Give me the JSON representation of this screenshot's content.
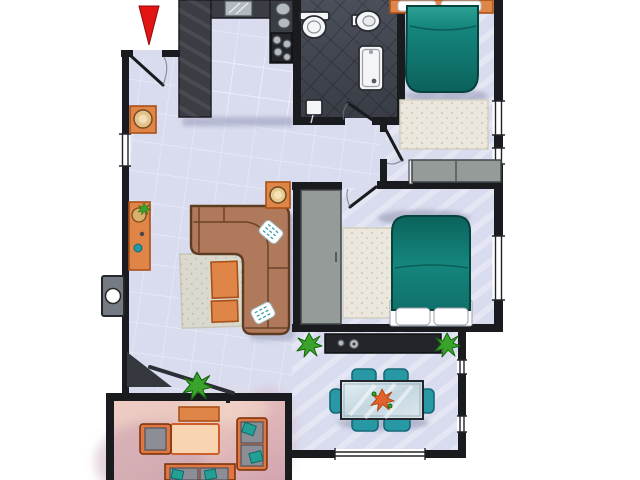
{
  "image": {
    "kind": "hand-drawn apartment floor plan illustration",
    "visible_text": "none",
    "orientation": "top-down",
    "cropped_edges": [
      "top",
      "bottom"
    ]
  },
  "palette": {
    "outside": "#ffffff",
    "wall": "#1a1b1f",
    "floor_main": "#d9dcef",
    "tile_line": "#f4f6ff",
    "floor_bath": "#4a4f59",
    "bath_grout": "#343842",
    "counter": "#3a3d44",
    "counter_dark": "#23252a",
    "balcony": "#e5bfbc",
    "balcony_shade": "#bb93a8",
    "rug": "#ebe7dc",
    "rug_living": "#dbd9ce",
    "sofa": "#b0795b",
    "sofa_line": "#5e3c22",
    "teal": "#15867d",
    "teal_dark": "#0a5a55",
    "orange": "#e08548",
    "orange_deep": "#a85118",
    "peach": "#f8d4b0",
    "chair": "#2798a4",
    "chair_dark": "#136a76",
    "plant": "#3aa32b",
    "plant_dark": "#17660d",
    "gray_furniture": "#959b99",
    "gray_cushion": "#8d8d96",
    "metal": "#b3bac1",
    "red": "#e21414",
    "white": "#ffffff",
    "glass": "#ccdbe4",
    "shadow": "#8d92ad"
  },
  "markers": {
    "entrance_arrow": {
      "shape": "triangle-pointing-down",
      "color": "#e21414"
    },
    "exterior_utility_box": {
      "shape": "gray-box-with-circle",
      "location": "outside-left-wall"
    }
  },
  "rooms": {
    "entry": {
      "name": "Entry",
      "features": [
        "entrance-door-open",
        "orange-stool"
      ]
    },
    "kitchen": {
      "name": "Kitchen",
      "features": [
        "u-shaped-dark-counter",
        "sink",
        "cooktop-burners",
        "pots"
      ]
    },
    "bathroom": {
      "name": "Bathroom",
      "features": [
        "dark-tiled-floor",
        "toilet",
        "bidet",
        "shower-tray",
        "floor-scale",
        "door"
      ]
    },
    "hallway": {
      "name": "Hallway",
      "features": []
    },
    "bedroom_main": {
      "name": "Bedroom 1",
      "features": [
        "teal-double-bed",
        "orange-headboard",
        "two-pillows",
        "beige-rug",
        "gray-wardrobe",
        "door",
        "windows-right-wall"
      ]
    },
    "bedroom_second": {
      "name": "Bedroom 2",
      "features": [
        "teal-double-bed",
        "two-pillows",
        "beige-rug",
        "gray-wardrobe",
        "door",
        "window-right-wall"
      ]
    },
    "living_room": {
      "name": "Living Room",
      "features": [
        "l-shaped-brown-sofa",
        "two-teal-pillows",
        "gray-rug",
        "two-orange-ottomans",
        "orange-console",
        "side-table-with-lamp",
        "corner-shelf",
        "plant",
        "window-left-wall"
      ]
    },
    "dining_room": {
      "name": "Dining Room",
      "features": [
        "dark-sideboard",
        "two-plants",
        "glass-table",
        "six-teal-chairs",
        "orange-centerpiece",
        "windows"
      ]
    },
    "balcony": {
      "name": "Balcony",
      "features": [
        "pink-floor",
        "orange-bench",
        "peach-coffee-table",
        "armchair",
        "loveseat",
        "outdoor-sofa"
      ]
    }
  }
}
